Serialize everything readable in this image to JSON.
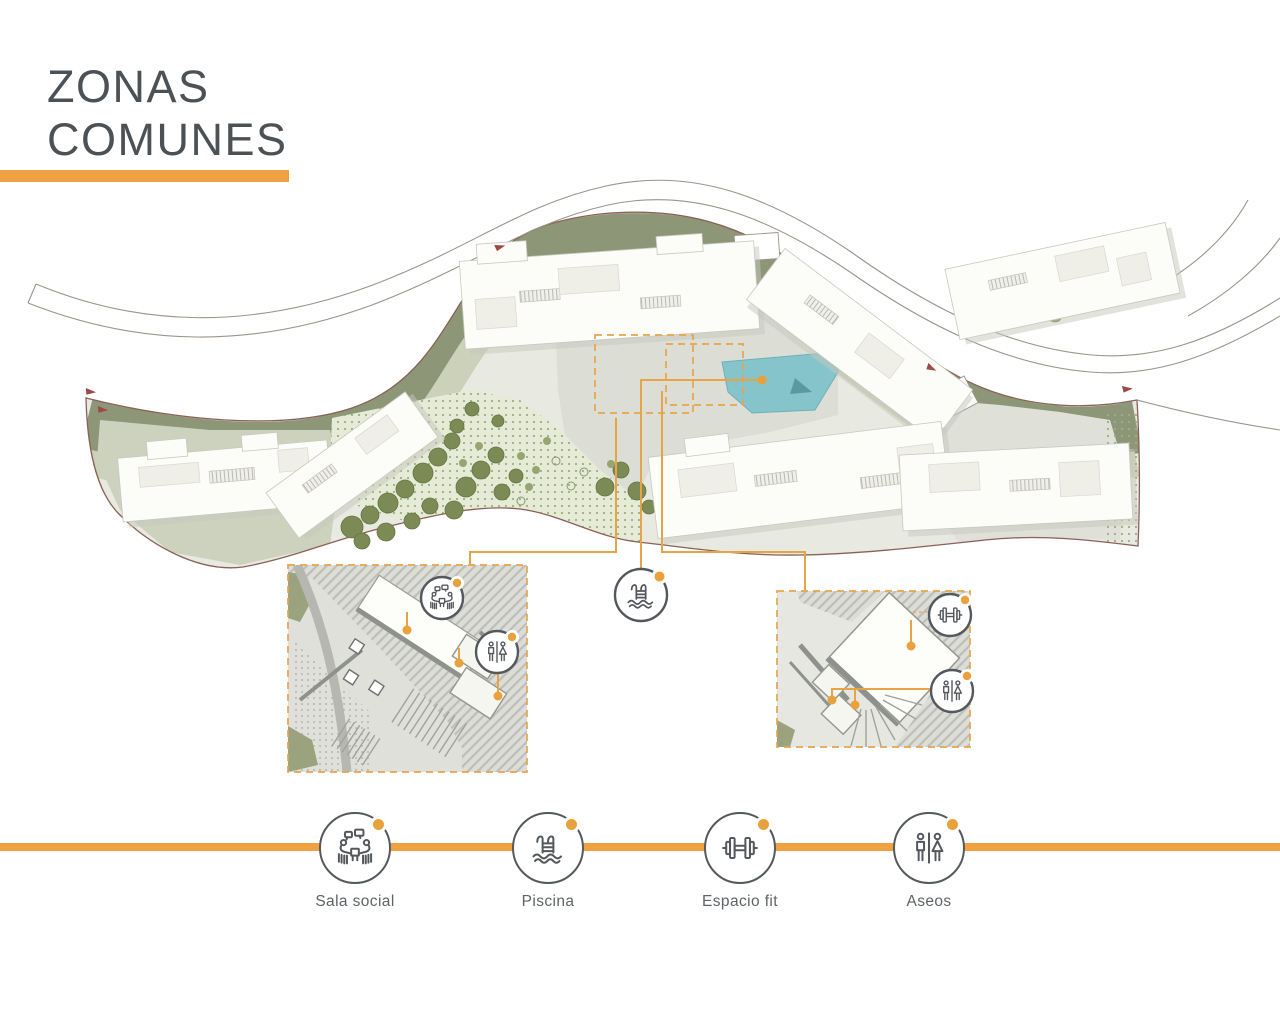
{
  "title": {
    "line1": "ZONAS",
    "line2": "COMUNES"
  },
  "legend": {
    "items": [
      {
        "id": "sala-social",
        "label": "Sala social",
        "icon": "meeting-icon"
      },
      {
        "id": "piscina",
        "label": "Piscina",
        "icon": "pool-ladder-icon"
      },
      {
        "id": "espacio-fit",
        "label": "Espacio fit",
        "icon": "dumbbell-icon"
      },
      {
        "id": "aseos",
        "label": "Aseos",
        "icon": "restroom-icon"
      }
    ]
  },
  "plan": {
    "type": "site-masterplan",
    "callouts": [
      {
        "id": "sala-social",
        "icon": "meeting-icon",
        "target": "left-detail-inset"
      },
      {
        "id": "aseos-left",
        "icon": "restroom-icon",
        "target": "left-detail-inset"
      },
      {
        "id": "piscina",
        "icon": "pool-ladder-icon",
        "target": "pool"
      },
      {
        "id": "espacio-fit",
        "icon": "dumbbell-icon",
        "target": "right-detail-inset"
      },
      {
        "id": "aseos-right",
        "icon": "restroom-icon",
        "target": "right-detail-inset"
      }
    ]
  },
  "colors": {
    "accent_orange": "#F0A243",
    "leader_orange": "#E7A445",
    "marker_dot": "#E9A13C",
    "title_text": "#4C5155",
    "label_text": "#5E6367",
    "icon_stroke": "#54585C",
    "pool_water": "#85C4CA",
    "landscape_olive": "#8D9778",
    "parcel_fill": "#E8E9E1",
    "parcel_outline": "#8A6157",
    "road_outline": "#9A948B",
    "building_fill": "#FCFCF9",
    "tree_green": "#7C8B55"
  }
}
